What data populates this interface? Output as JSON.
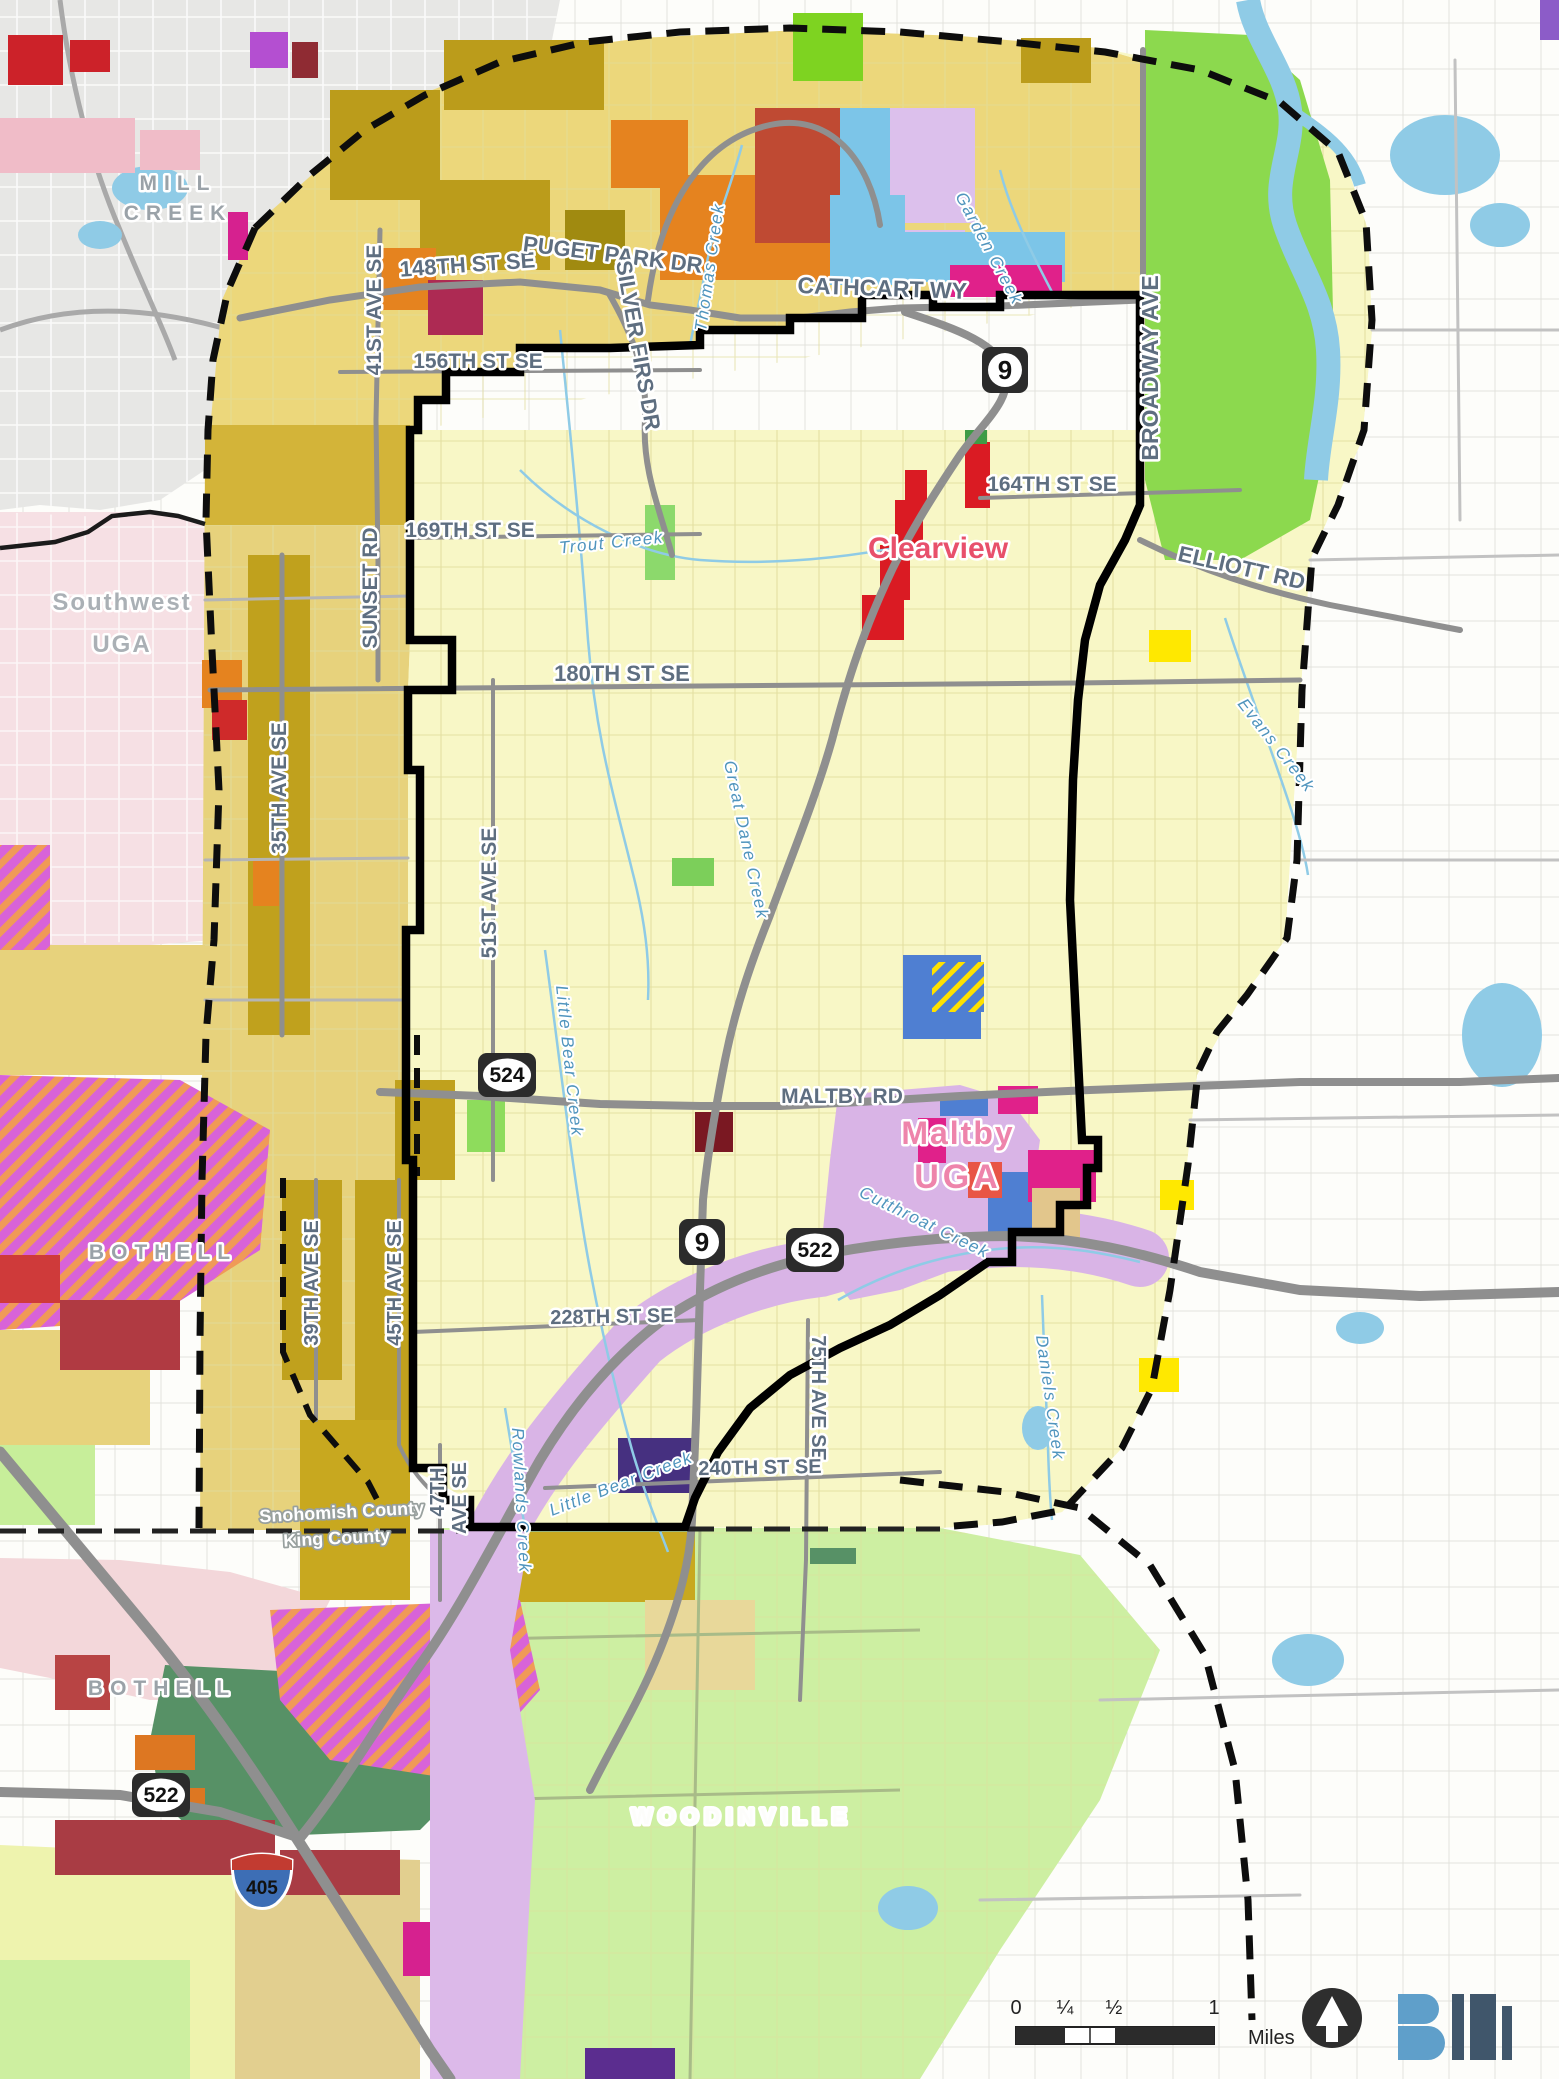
{
  "cities": {
    "mill_creek_1": "MILL",
    "mill_creek_2": "CREEK",
    "southwest_uga_1": "Southwest",
    "southwest_uga_2": "UGA",
    "bothell_north": "BOTHELL",
    "bothell_south": "BOTHELL",
    "woodinville": "WOODINVILLE"
  },
  "communities": {
    "clearview": "Clearview",
    "maltby_1": "Maltby",
    "maltby_2": "UGA"
  },
  "roads": {
    "st148": "148TH ST SE",
    "puget": "PUGET PARK DR",
    "silver": "SILVER FIRS DR",
    "cathcart": "CATHCART WY",
    "ave41": "41ST AVE SE",
    "st156": "156TH ST SE",
    "sunset": "SUNSET RD",
    "st169": "169TH ST SE",
    "broadway": "BROADWAY AVE",
    "st164": "164TH ST SE",
    "elliott": "ELLIOTT RD",
    "st180": "180TH ST SE",
    "ave35": "35TH AVE SE",
    "ave51": "51ST AVE SE",
    "maltby_rd": "MALTBY RD",
    "ave39": "39TH AVE SE",
    "ave45": "45TH AVE SE",
    "st228": "228TH ST SE",
    "ave75": "75TH AVE SE",
    "ave47a": "47TH",
    "ave47b": "AVE SE",
    "st240": "240TH ST SE"
  },
  "creeks": {
    "thomas": "Thomas Creek",
    "garden": "Garden Creek",
    "trout": "Trout Creek",
    "great_dane": "Great Dane Creek",
    "evans": "Evans Creek",
    "little_bear": "Little Bear Creek",
    "little_bear2": "Little Bear Creek",
    "rowlands": "Rowlands Creek",
    "cutthroat": "Cutthroat Creek",
    "daniels": "Daniels Creek"
  },
  "shields": {
    "sr9": "9",
    "sr9_south": "9",
    "sr524": "524",
    "sr522": "522",
    "sr522_west": "522",
    "i405": "405"
  },
  "county_line": {
    "line1": "Snohomish County",
    "line2": "King County"
  },
  "scale_bar": {
    "t0": "0",
    "t1": "¼",
    "t2": "½",
    "t3": "1",
    "unit": "Miles"
  },
  "colors": {
    "study_area_fill": "#f8f7c6",
    "uga_band_fill": "#e9d57c",
    "outside_fill": "#ffffff",
    "mill_creek_fill": "#e7e7e5",
    "pink_uga_fill": "#f6e0e4",
    "park_green": "#8cd94e",
    "light_green": "#cdefa2",
    "dark_green": "#579166",
    "lavender": "#d9b4e6",
    "olive": "#bb9c1b",
    "orange": "#e5831f",
    "red": "#da1b23",
    "dark_red": "#a93c44",
    "magenta": "#e0218a",
    "hatch_pink": "#d863d8",
    "hatch_orange": "#f09a57",
    "blue": "#4f7fd2",
    "cyan": "#7cc5e8",
    "water": "#8fcbe6",
    "yellow": "#ffe800",
    "purple": "#4b3a85",
    "boundary": "#000000",
    "road_gray": "#8f8f8f",
    "road_label": "#5e6e80",
    "creek_label": "#4f94bd",
    "city_label": "#9aa2a8",
    "community_label": "#e8506b"
  }
}
